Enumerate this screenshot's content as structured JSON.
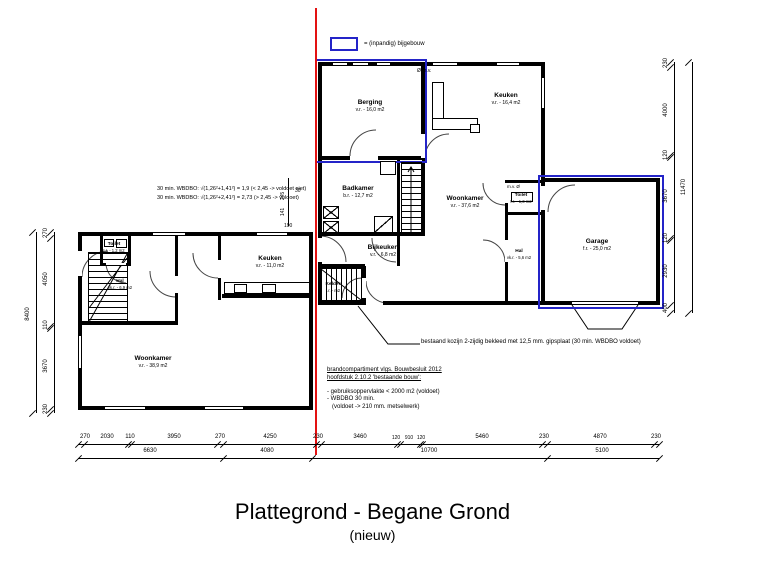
{
  "title": {
    "main": "Plattegrond - Begane Grond",
    "sub": "(nieuw)"
  },
  "legend": {
    "label": "= (inpandig) bijgebouw"
  },
  "colors": {
    "red_line": "#e31212",
    "blue_outline": "#2424c8",
    "wall": "#000000"
  },
  "rooms": [
    {
      "name": "Berging",
      "area": "v.r. - 16,0 m2"
    },
    {
      "name": "Keuken",
      "area": "v.r. - 16,4 m2"
    },
    {
      "name": "Badkamer",
      "area": "b.r. - 12,7 m2"
    },
    {
      "name": "Woonkamer",
      "area": "v.r. - 37,6 m2"
    },
    {
      "name": "Toilet",
      "area": "t.r. - 1,3 m2"
    },
    {
      "name": "Hal",
      "area": "vk.r. - 5,6 m2"
    },
    {
      "name": "Garage",
      "area": "f.r. - 25,0 m2"
    },
    {
      "name": "Bijkeuken",
      "area": "v.r. - 6,8 m2"
    },
    {
      "name": "Kelder",
      "area": "t.r. - m2"
    },
    {
      "name": "Toilet",
      "area": "t.r. - 1,2 m2"
    },
    {
      "name": "Hal",
      "area": "vk.r. - 6,9 m2"
    },
    {
      "name": "Keuken",
      "area": "v.r. - 11,0 m2"
    },
    {
      "name": "Woonkamer",
      "area": "v.r. - 38,9 m2"
    }
  ],
  "markers": {
    "mv_top": "Ø m.v.",
    "mv_toilet": "m.v. Ø"
  },
  "notes": {
    "wbdbo_calc_1": "30 min. WBDBO: √(1,26²+1,41²) = 1,9 (< 2,45 -> voldoet niet)",
    "wbdbo_calc_2": "30 min. WBDBO: √(1,26²+2,41²) = 2,73 (> 2,45 -> voldoet)",
    "kozijn": "bestaand kozijn 2-zijdig bekleed met 12,5 mm. gipsplaat (30 min. WBDBO voldoet)",
    "brand_heading_1": "brandcompartiment vlgs. Bouwbesluit 2012",
    "brand_heading_2": "hoofdstuk 2.10.2 'bestaande bouw':",
    "brand_item_1": "- gebruiksoppervlakte < 2000 m2 (voldoet)",
    "brand_item_2": "- WBDBO 30 min.",
    "brand_item_3": "(voldoet -> 210 mm. metselwerk)"
  },
  "dims": {
    "bottom_row1": [
      "270",
      "2030",
      "110",
      "3950",
      "270",
      "4250",
      "230",
      "3460",
      "120",
      "910",
      "120",
      "5460",
      "230",
      "4870",
      "230"
    ],
    "bottom_row2": [
      "6630",
      "4080",
      "10700",
      "5100"
    ],
    "right_col": [
      "230",
      "4000",
      "120",
      "3670",
      "120",
      "2930",
      "400"
    ],
    "right_total": "11470",
    "left_col": [
      "270",
      "4050",
      "110",
      "3670",
      "230"
    ],
    "left_total": "8400",
    "detail": [
      "30",
      "245",
      "141",
      "190"
    ]
  }
}
